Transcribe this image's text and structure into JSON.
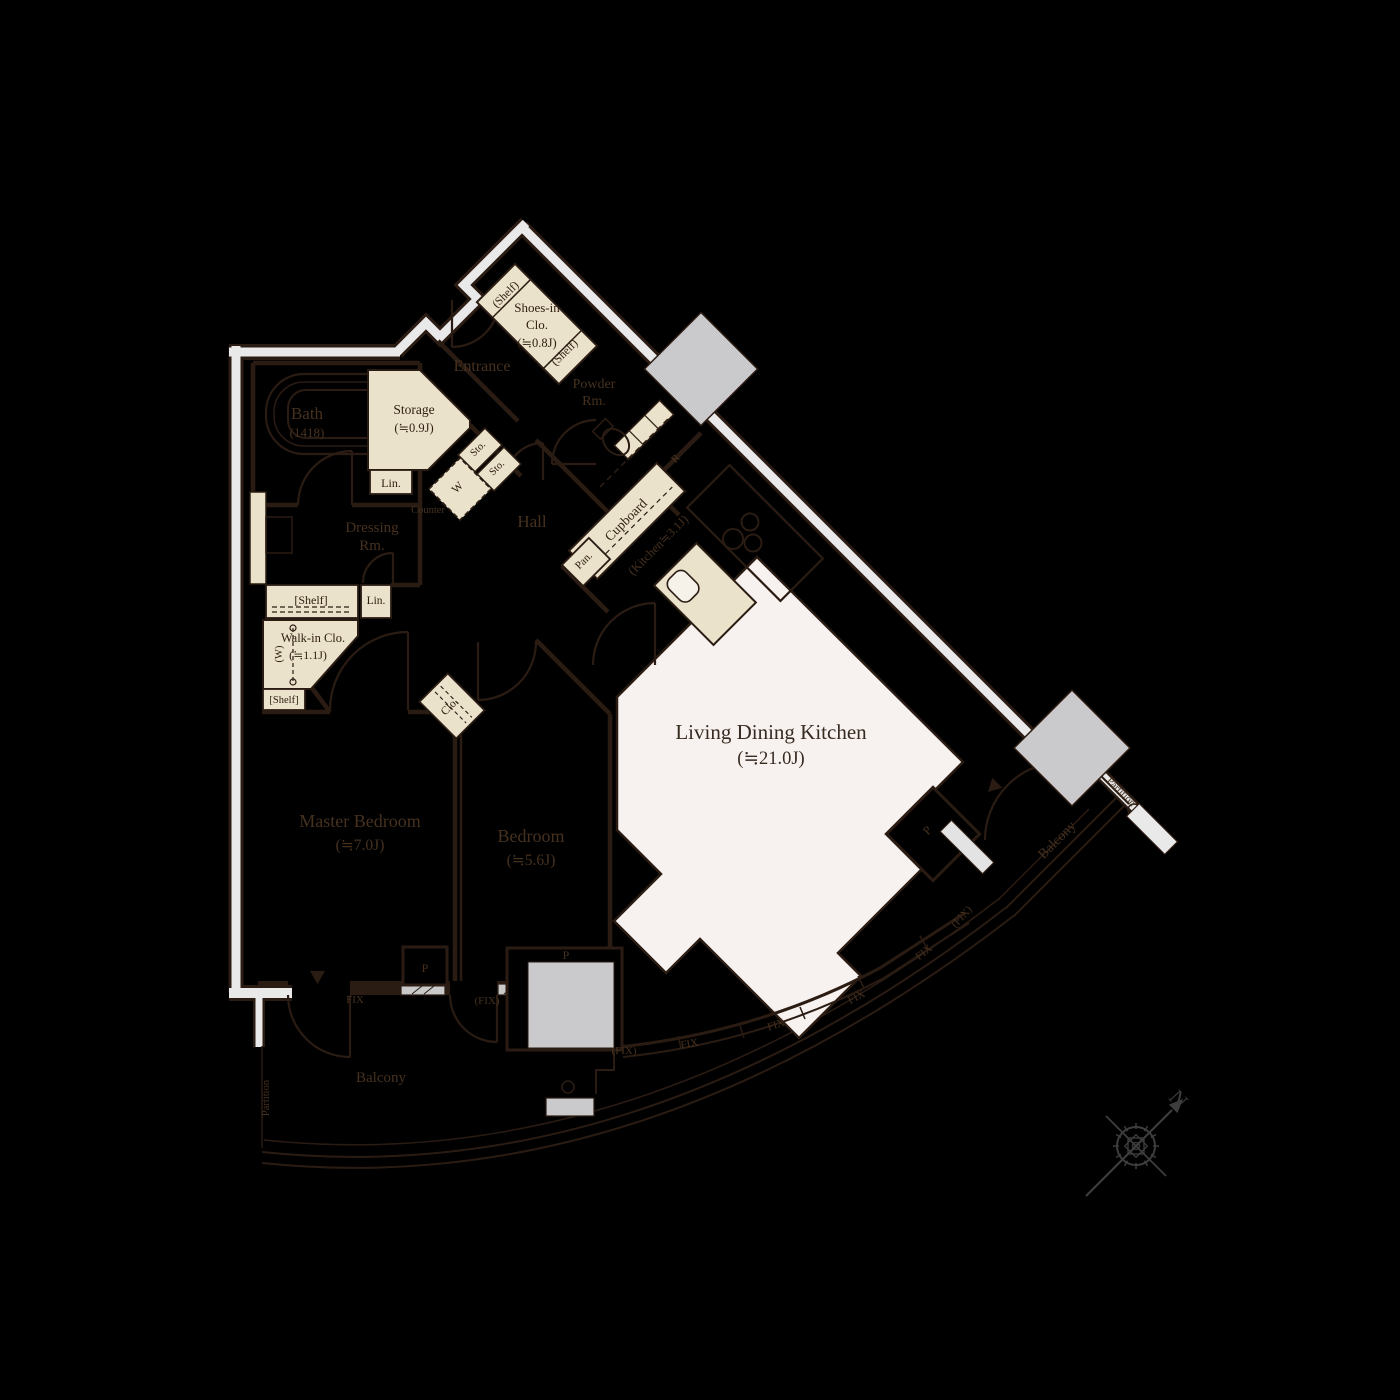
{
  "colors": {
    "background": "#000000",
    "wall_line": "#2b1c13",
    "outer_wall_fill": "#e9e9e9",
    "closet_fill": "#eae2ca",
    "ldk_floor_fill": "#f7f2ef",
    "pillar_fill": "#cacacd",
    "label_on_dark": "#46311f",
    "label_on_light": "#2e1d10",
    "compass_color": "#3d3d3d"
  },
  "rooms": {
    "ldk": {
      "name": "Living Dining Kitchen",
      "area": "(≒21.0J)"
    },
    "kitchen": {
      "label": "(Kitchen≒3.1J)"
    },
    "master_bedroom": {
      "name": "Master Bedroom",
      "area": "(≒7.0J)"
    },
    "bedroom": {
      "name": "Bedroom",
      "area": "(≒5.6J)"
    },
    "bath": {
      "name": "Bath",
      "area": "(1418)"
    },
    "dressing_room": {
      "line1": "Dressing",
      "line2": "Rm."
    },
    "powder_room": {
      "line1": "Powder",
      "line2": "Rm."
    },
    "entrance": {
      "name": "Entrance"
    },
    "hall": {
      "name": "Hall"
    },
    "storage": {
      "name": "Storage",
      "area": "(≒0.9J)"
    },
    "shoes_in_closet": {
      "line1": "Shoes-in",
      "line2": "Clo.",
      "area": "(≒0.8J)"
    },
    "walk_in_closet": {
      "name": "Walk-in Clo.",
      "area": "(≒1.1J)"
    },
    "balcony_south": {
      "name": "Balcony"
    },
    "balcony_east": {
      "name": "Balcony"
    }
  },
  "labels": {
    "shelf_paren": "(Shelf)",
    "shelf_bracket": "[Shelf]",
    "linen": "Lin.",
    "sto": "Sto.",
    "washer": "W",
    "washer_paren": "(W)",
    "counter": "Counter",
    "cupboard": "Cupboard",
    "pantry": "Pan.",
    "refrigerator": "R",
    "closet": "Clo.",
    "pillar": "P",
    "partition": "Partition",
    "fix": "FIX",
    "fix_paren": "(FIX)",
    "north": "N"
  }
}
